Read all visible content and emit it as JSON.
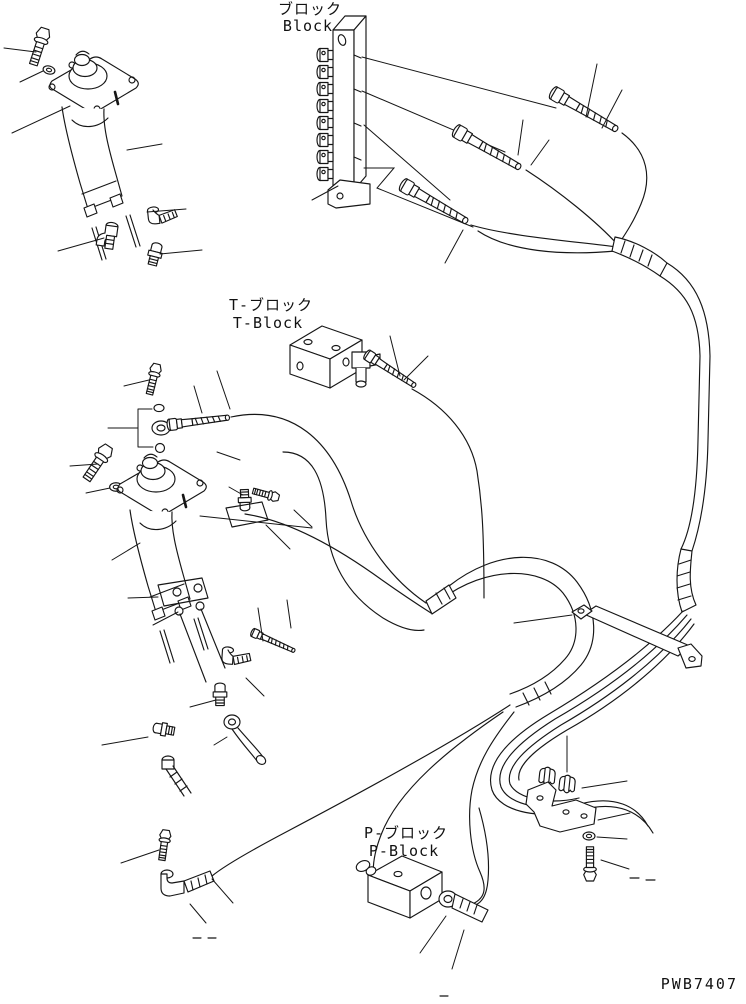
{
  "page": {
    "background": "#ffffff",
    "line_color": "#161616"
  },
  "labels": {
    "manifold_block": {
      "jp": "ブロック",
      "en": "Block"
    },
    "t_block": {
      "jp": "T-ブロック",
      "en": "T-Block"
    },
    "p_block": {
      "jp": "P-ブロック",
      "en": "P-Block"
    }
  },
  "part_code": "PWB7407",
  "figure": {
    "type": "exploded-parts-line-drawing",
    "components": [
      "ppc-valve-upper",
      "ppc-valve-lower",
      "manifold-block",
      "t-block",
      "p-block",
      "hose-connectors",
      "elbow-fittings",
      "nipple-fittings",
      "mounting-bolts",
      "washers",
      "hose-clamps",
      "clamp-bracket",
      "strap-bracket",
      "hydraulic-hoses"
    ]
  }
}
